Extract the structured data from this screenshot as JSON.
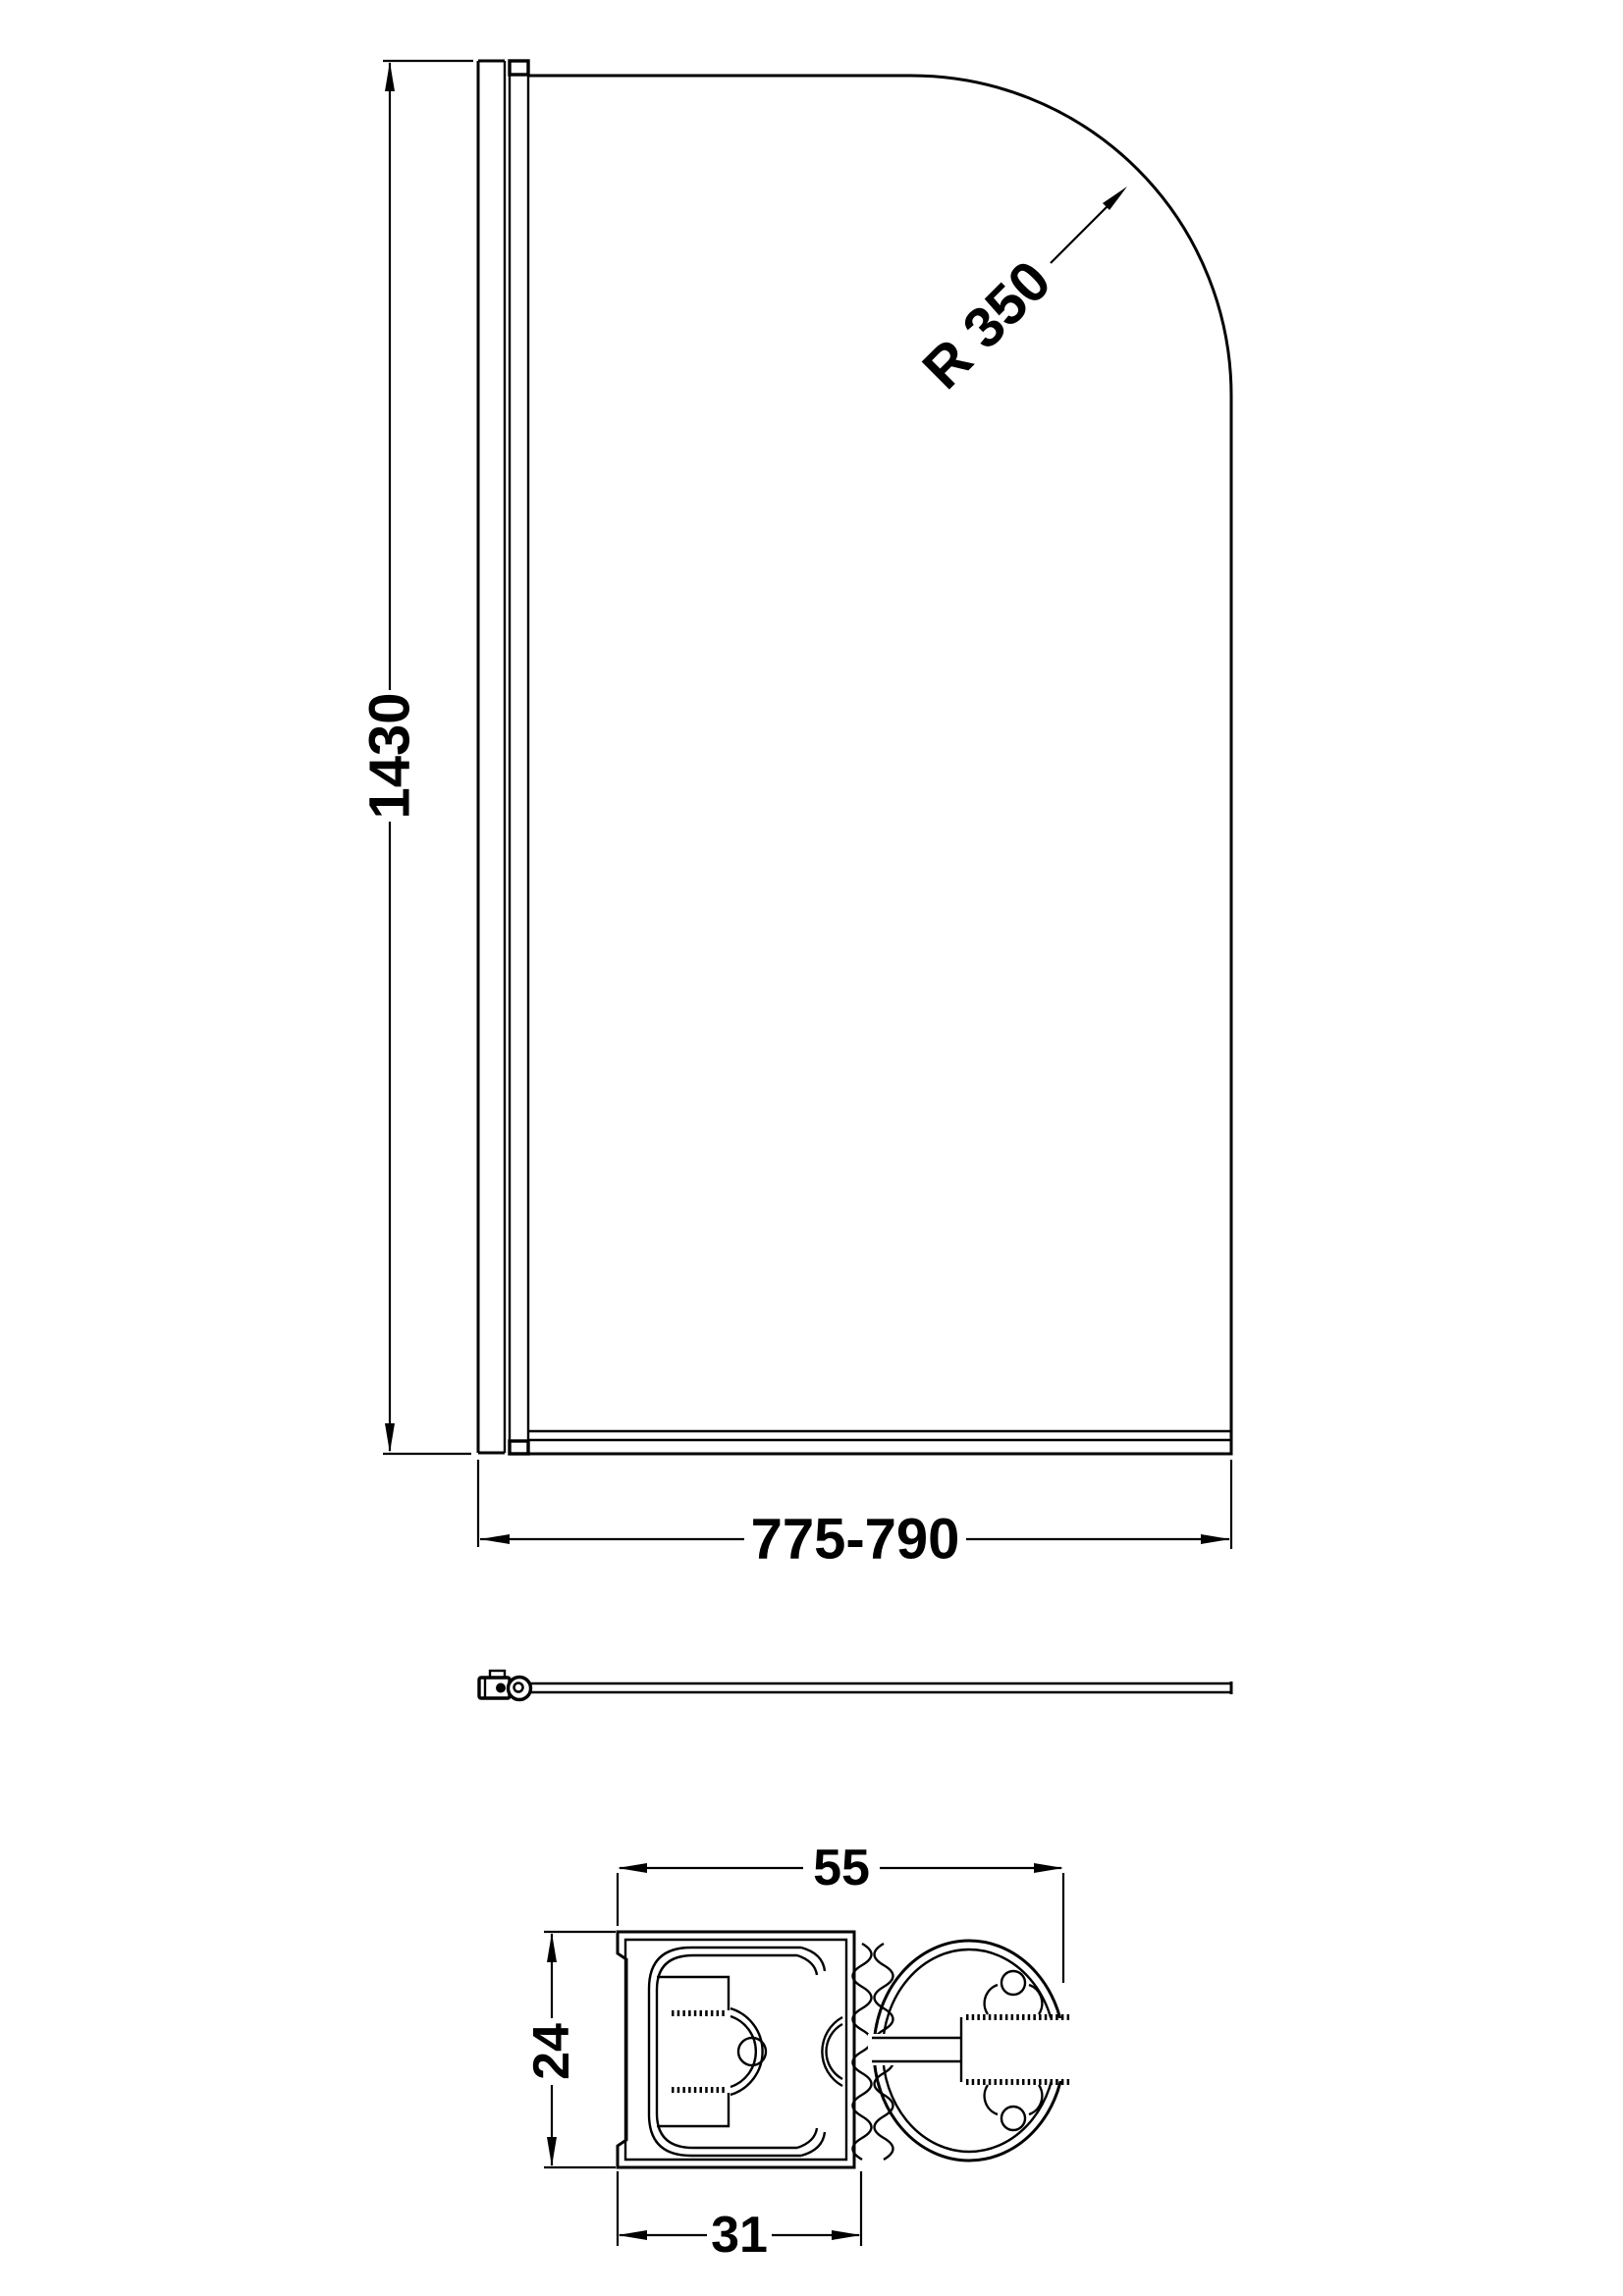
{
  "page": {
    "background": "#ffffff",
    "line_color": "#000000"
  },
  "elevation": {
    "height_label": "1430",
    "width_label": "775-790",
    "radius_label": "R 350"
  },
  "profile_section": {
    "overall_width_label": "55",
    "depth_label": "24",
    "channel_width_label": "31"
  }
}
